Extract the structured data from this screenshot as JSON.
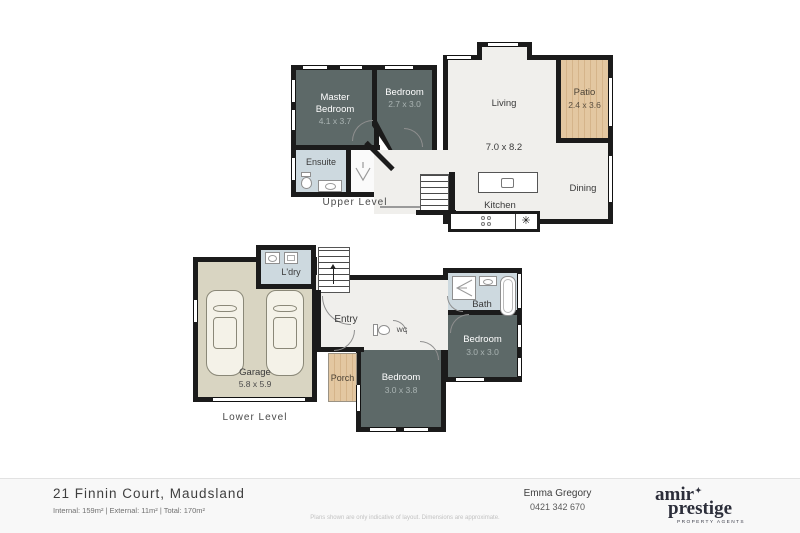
{
  "palette": {
    "wall": "#1b1b1b",
    "room_dark": "#5d6968",
    "room_light": "#f0efec",
    "room_wet": "#cdd9df",
    "garage_floor": "#d9d5c2",
    "wood_deck": "#dcbd95",
    "footer_bg": "#f8f8f8",
    "logo_ink": "#2c2e3a"
  },
  "upper_level": {
    "level_label": "Upper Level",
    "rooms": {
      "master_bedroom": {
        "name_line1": "Master",
        "name_line2": "Bedroom",
        "dims": "4.1 x 3.7"
      },
      "bedroom": {
        "name": "Bedroom",
        "dims": "2.7 x 3.0"
      },
      "ensuite": {
        "name": "Ensuite"
      },
      "living": {
        "name": "Living",
        "dims": "7.0 x 8.2"
      },
      "patio": {
        "name": "Patio",
        "dims": "2.4 x 3.6"
      },
      "dining": {
        "name": "Dining"
      },
      "kitchen": {
        "name": "Kitchen",
        "appliance_symbol": "✳"
      }
    }
  },
  "lower_level": {
    "level_label": "Lower Level",
    "rooms": {
      "garage": {
        "name": "Garage",
        "dims": "5.8 x 5.9"
      },
      "laundry": {
        "name": "L'dry"
      },
      "entry": {
        "name": "Entry"
      },
      "wc": {
        "name": "WC"
      },
      "bath": {
        "name": "Bath"
      },
      "bedroom_rear": {
        "name": "Bedroom",
        "dims": "3.0 x 3.0"
      },
      "bedroom_front": {
        "name": "Bedroom",
        "dims": "3.0 x 3.8"
      },
      "porch": {
        "name": "Porch"
      }
    }
  },
  "footer": {
    "address": "21 Finnin Court, Maudsland",
    "areas": "Internal: 159m² | External: 11m² | Total: 170m²",
    "disclaimer": "Plans shown are only indicative of layout. Dimensions are approximate.",
    "agent": {
      "name": "Emma Gregory",
      "phone": "0421 342 670"
    },
    "logo": {
      "line1": "amir",
      "star": "✦",
      "line2": "prestige",
      "tagline": "PROPERTY AGENTS"
    }
  }
}
